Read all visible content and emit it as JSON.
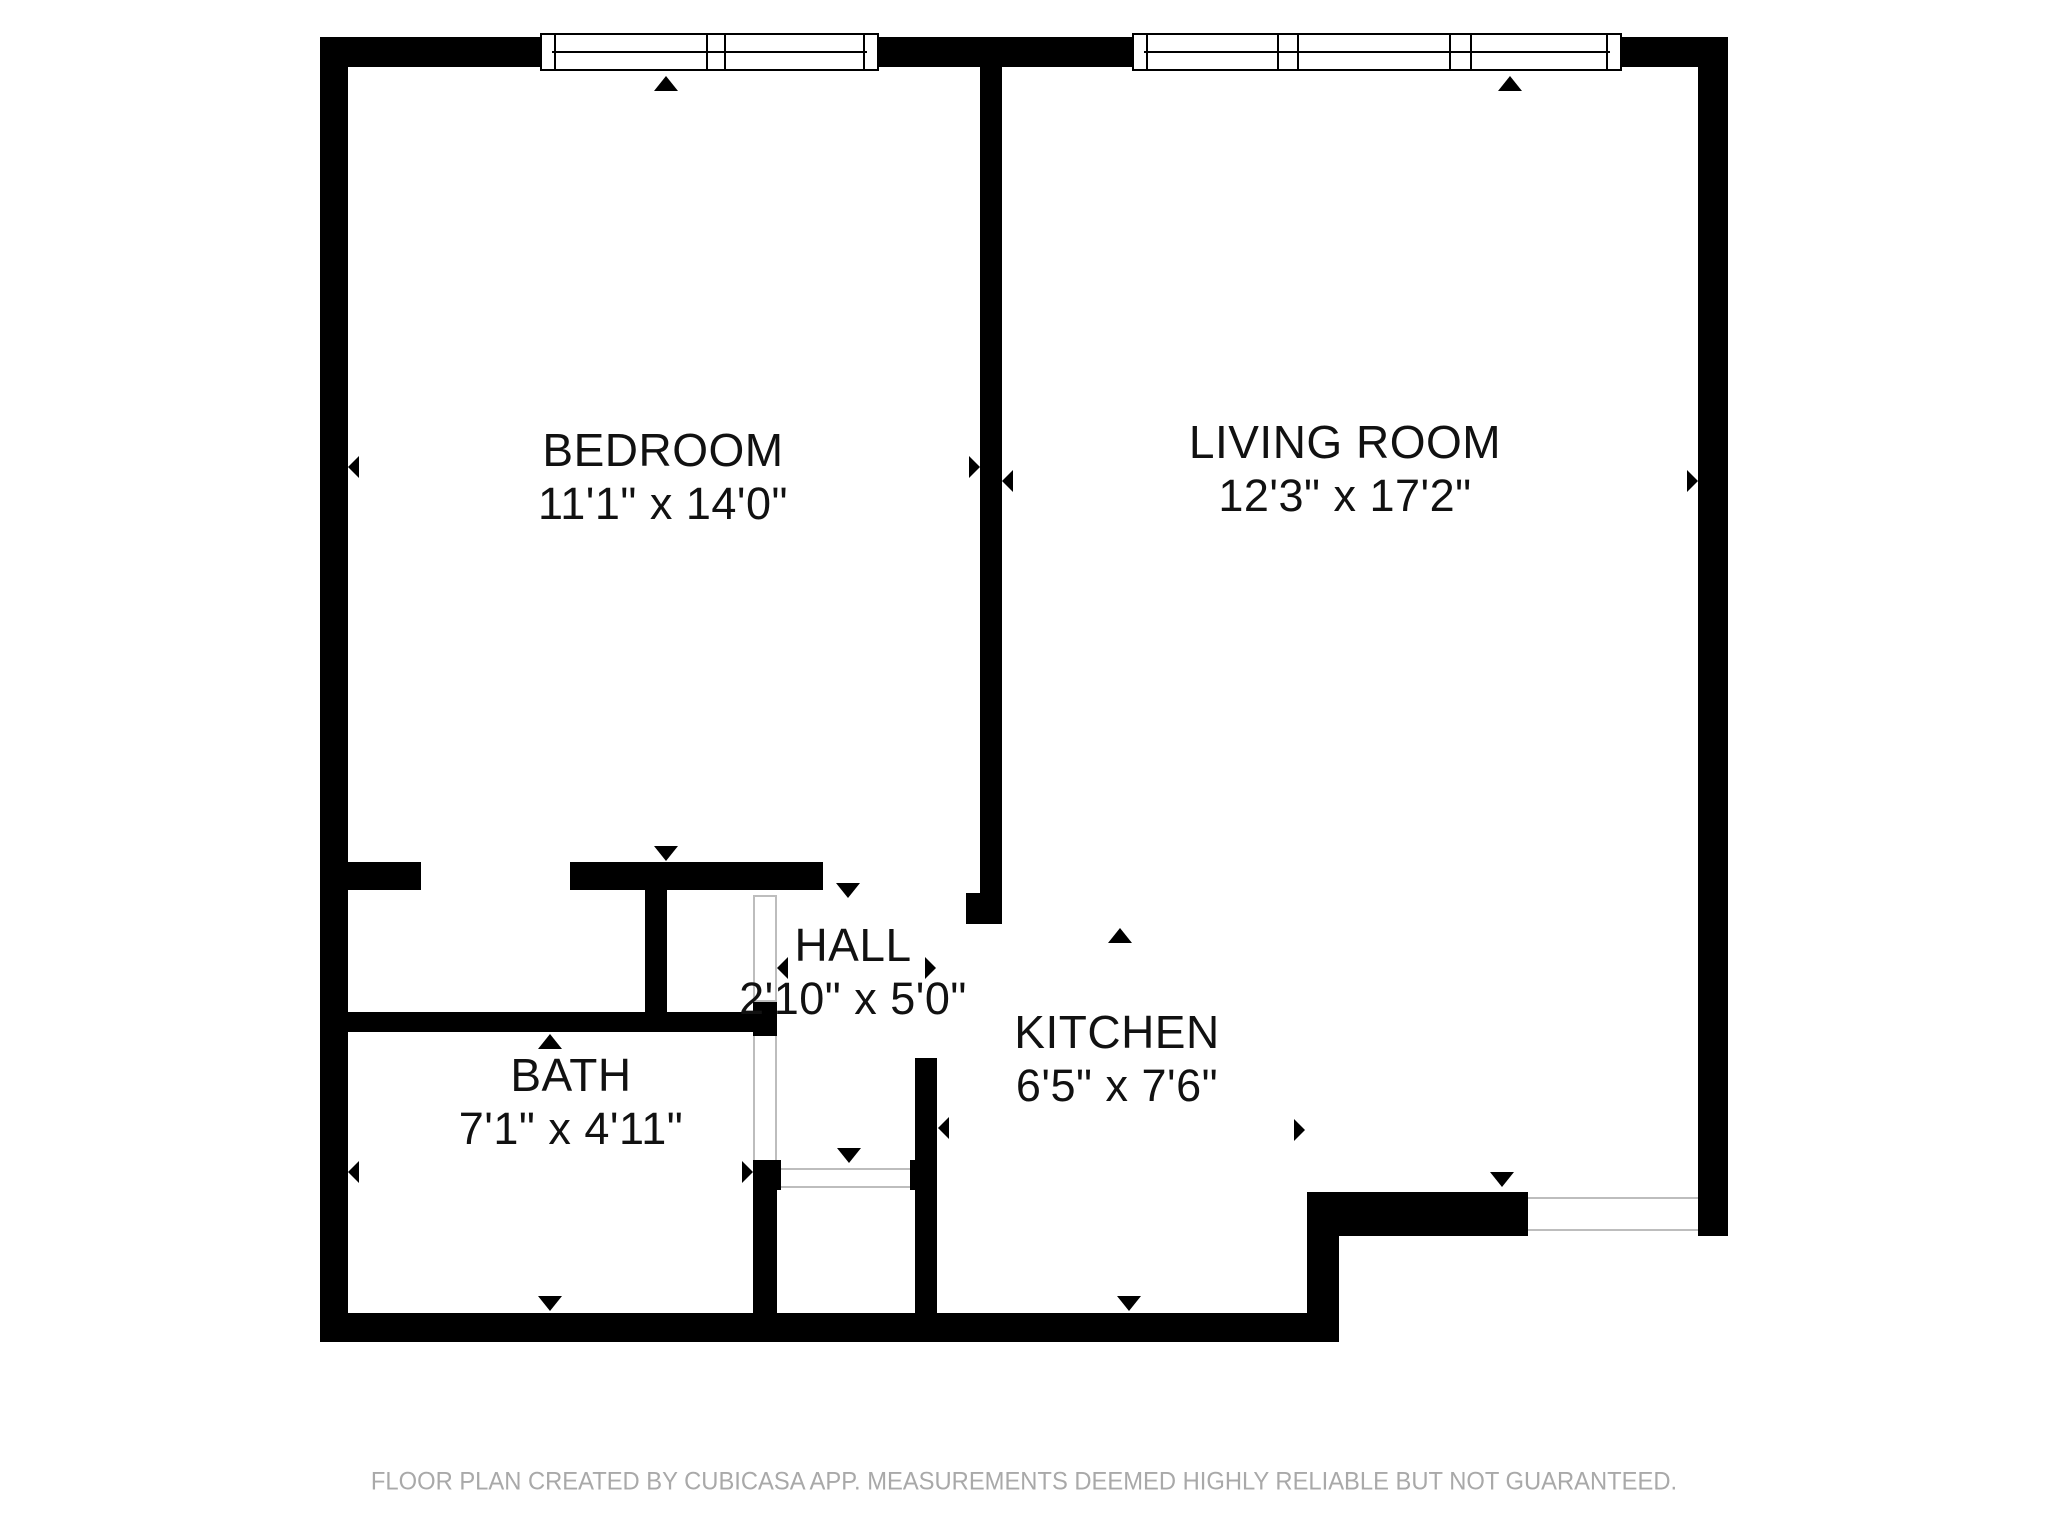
{
  "plan": {
    "creator_footer": "FLOOR PLAN CREATED BY CUBICASA APP. MEASUREMENTS DEEMED HIGHLY RELIABLE BUT NOT GUARANTEED."
  },
  "rooms": [
    {
      "id": "bedroom",
      "name": "BEDROOM",
      "dims": "11'1\" x 14'0\""
    },
    {
      "id": "living-room",
      "name": "LIVING ROOM",
      "dims": "12'3\" x 17'2\""
    },
    {
      "id": "hall",
      "name": "HALL",
      "dims": "2'10\" x 5'0\""
    },
    {
      "id": "kitchen",
      "name": "KITCHEN",
      "dims": "6'5\" x 7'6\""
    },
    {
      "id": "bath",
      "name": "BATH",
      "dims": "7'1\" x 4'11\""
    }
  ],
  "features": {
    "windows": [
      {
        "id": "bedroom-window",
        "location": "top wall, bedroom",
        "panes": 2
      },
      {
        "id": "living-room-window",
        "location": "top wall, living room",
        "panes": 3
      }
    ],
    "doors": [
      {
        "id": "bedroom-door",
        "location": "bedroom bottom wall, open gap"
      },
      {
        "id": "bath-door",
        "location": "hall left wall, leaf drawn open"
      },
      {
        "id": "entry-door",
        "location": "hall bottom, between bath and kitchen"
      },
      {
        "id": "living-room-exit-door",
        "location": "living room bottom wall"
      }
    ],
    "marker_icon": "measurement triangle arrows at room wall midpoints and door openings"
  },
  "colors": {
    "background": "#ffffff",
    "wall": "#000000",
    "label_text": "#111111",
    "door_line": "#bdbdbd",
    "footer_text": "#a9a9a9"
  }
}
